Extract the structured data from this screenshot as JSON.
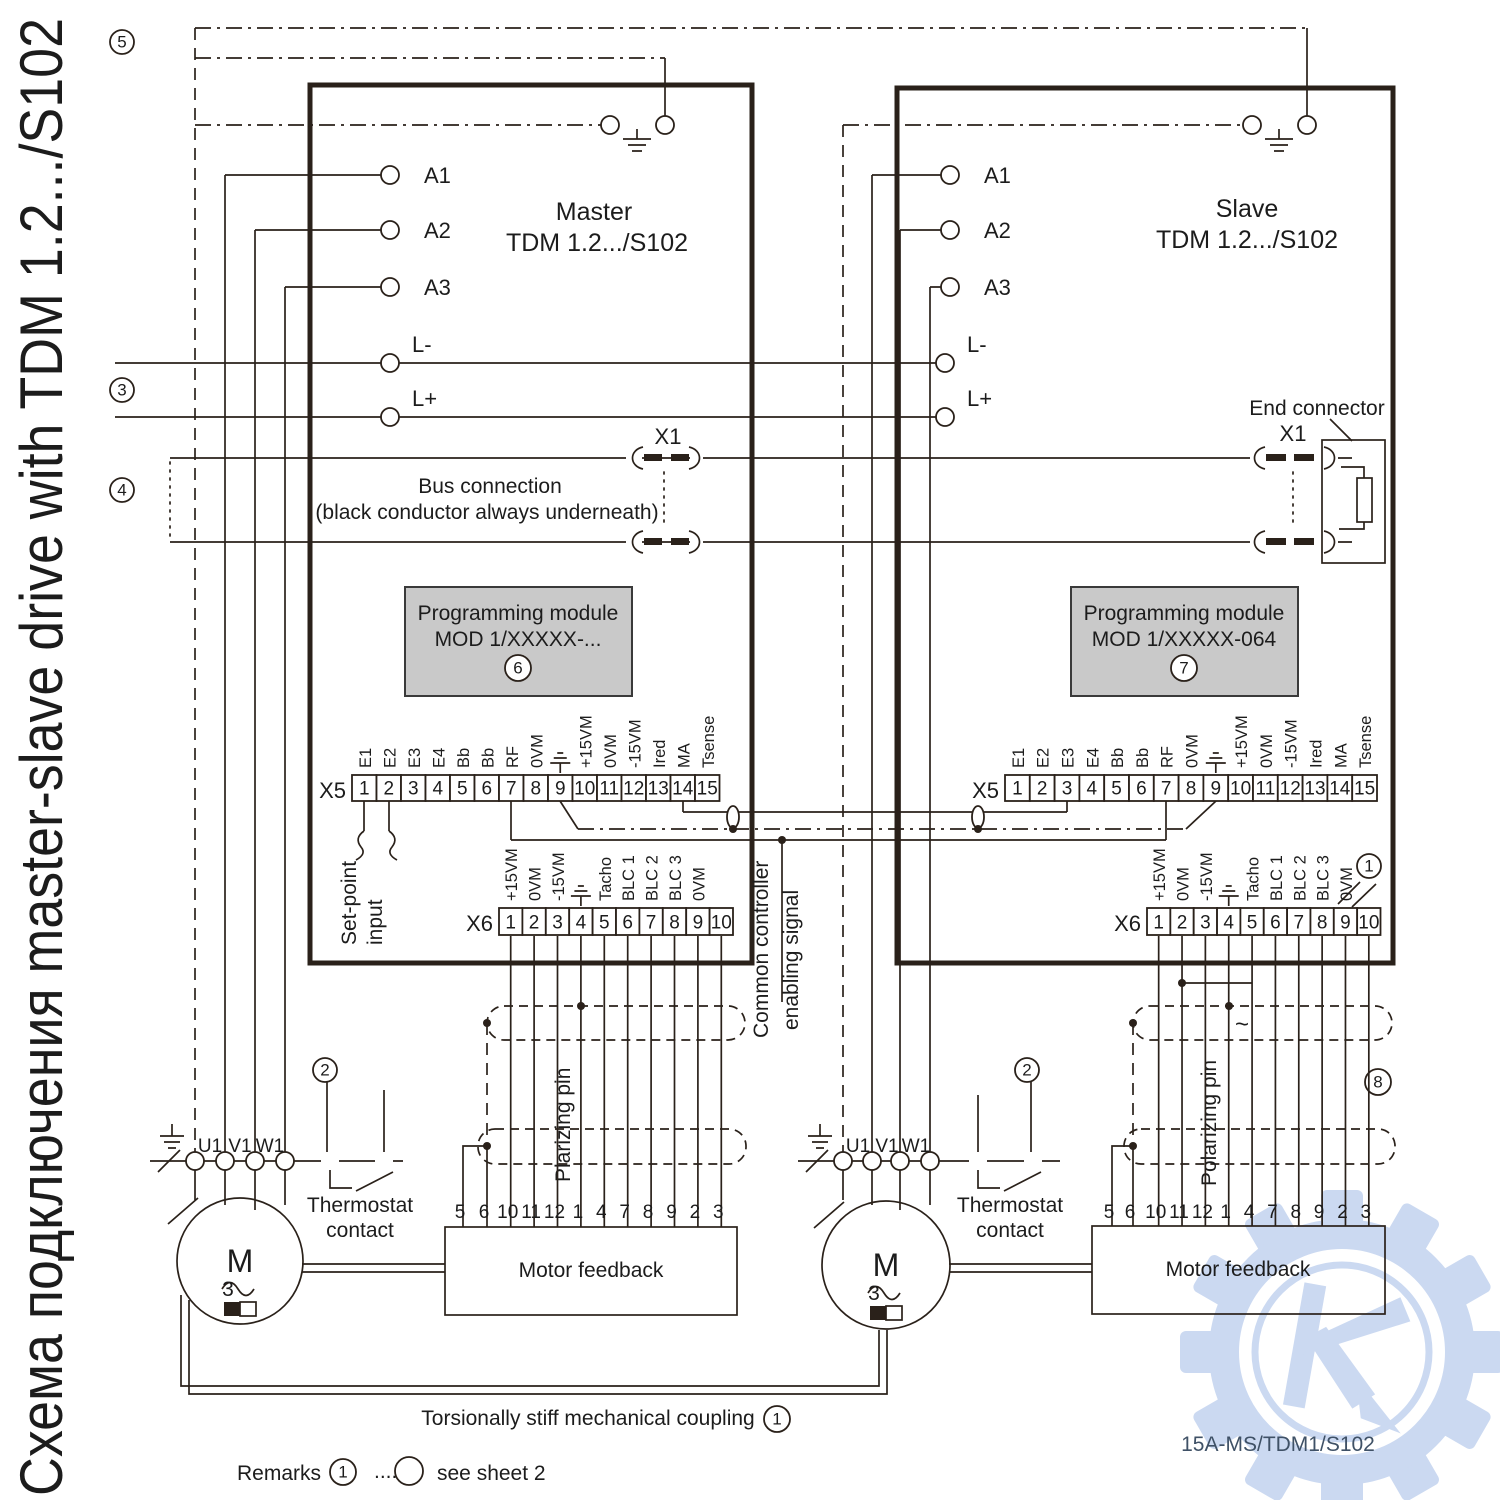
{
  "page": {
    "title": "Схема подключения master-slave drive with TDM 1.2.../S102",
    "doc_number": "15A-MS/TDM1/S102"
  },
  "annotations": {
    "n5": "5",
    "n3": "3",
    "n4": "4",
    "n8": "8",
    "coupling": "Torsionally stiff mechanical coupling",
    "coupling_ref": "1",
    "remarks": "Remarks",
    "remarks_ref": "1",
    "remarks_dots": "....",
    "remarks_note": "see sheet 2"
  },
  "bus": {
    "x1": "X1",
    "line1": "Bus connection",
    "line2": "(black conductor always underneath)",
    "end_connector": "End connector"
  },
  "middle": {
    "enable1": "Common controller",
    "enable2": "enabling signal"
  },
  "master": {
    "name": "Master",
    "model": "TDM 1.2.../S102",
    "terminals": {
      "a1": "A1",
      "a2": "A2",
      "a3": "A3",
      "lminus": "L-",
      "lplus": "L+"
    },
    "module": {
      "line1": "Programming module",
      "line2": "MOD 1/XXXXX-...",
      "ref": "6"
    },
    "x5": {
      "label": "X5",
      "numbers": [
        "1",
        "2",
        "3",
        "4",
        "5",
        "6",
        "7",
        "8",
        "9",
        "10",
        "11",
        "12",
        "13",
        "14",
        "15"
      ],
      "signals": [
        "E1",
        "E2",
        "E3",
        "E4",
        "Bb",
        "Bb",
        "RF",
        "0VM",
        "GND",
        "+15VM",
        "0VM",
        "-15VM",
        "Ired",
        "MA",
        "Tsense"
      ]
    },
    "x6": {
      "label": "X6",
      "numbers": [
        "1",
        "2",
        "3",
        "4",
        "5",
        "6",
        "7",
        "8",
        "9",
        "10"
      ],
      "signals": [
        "+15VM",
        "0VM",
        "-15VM",
        "GND",
        "Tacho",
        "BLC 1",
        "BLC 2",
        "BLC 3",
        "0VM",
        ""
      ]
    },
    "setpoint": {
      "line1": "Set-point",
      "line2": "input"
    },
    "polarizing": "Plarizing pin",
    "thermostat": {
      "line1": "Thermostat",
      "line2": "contact",
      "ref": "2"
    },
    "motor": {
      "label": "M",
      "phase": "3"
    },
    "motor_terms": {
      "u1": "U1",
      "v1": "V1",
      "w1": "W1"
    },
    "feedback": {
      "label": "Motor feedback",
      "numbers": [
        "5",
        "6",
        "10",
        "11",
        "12",
        "1",
        "4",
        "7",
        "8",
        "9",
        "2",
        "3"
      ]
    }
  },
  "slave": {
    "name": "Slave",
    "model": "TDM 1.2.../S102",
    "terminals": {
      "a1": "A1",
      "a2": "A2",
      "a3": "A3",
      "lminus": "L-",
      "lplus": "L+"
    },
    "module": {
      "line1": "Programming module",
      "line2": "MOD 1/XXXXX-064",
      "ref": "7"
    },
    "x5": {
      "label": "X5",
      "numbers": [
        "1",
        "2",
        "3",
        "4",
        "5",
        "6",
        "7",
        "8",
        "9",
        "10",
        "11",
        "12",
        "13",
        "14",
        "15"
      ],
      "signals": [
        "E1",
        "E2",
        "E3",
        "E4",
        "Bb",
        "Bb",
        "RF",
        "0VM",
        "GND",
        "+15VM",
        "0VM",
        "-15VM",
        "Ired",
        "MA",
        "Tsense"
      ]
    },
    "x6": {
      "label": "X6",
      "numbers": [
        "1",
        "2",
        "3",
        "4",
        "5",
        "6",
        "7",
        "8",
        "9",
        "10"
      ],
      "signals": [
        "+15VM",
        "0VM",
        "-15VM",
        "GND",
        "Tacho",
        "BLC 1",
        "BLC 2",
        "BLC 3",
        "0VM",
        ""
      ],
      "ref": "1"
    },
    "tacho_wave": "~",
    "polarizing": "Polarizing pin",
    "thermostat": {
      "line1": "Thermostat",
      "line2": "contact",
      "ref": "2"
    },
    "motor": {
      "label": "M",
      "phase": "3"
    },
    "motor_terms": {
      "u1": "U1",
      "v1": "V1",
      "w1": "W1"
    },
    "feedback": {
      "label": "Motor feedback",
      "numbers": [
        "5",
        "6",
        "10",
        "11",
        "12",
        "1",
        "4",
        "7",
        "8",
        "9",
        "2",
        "3"
      ]
    }
  }
}
